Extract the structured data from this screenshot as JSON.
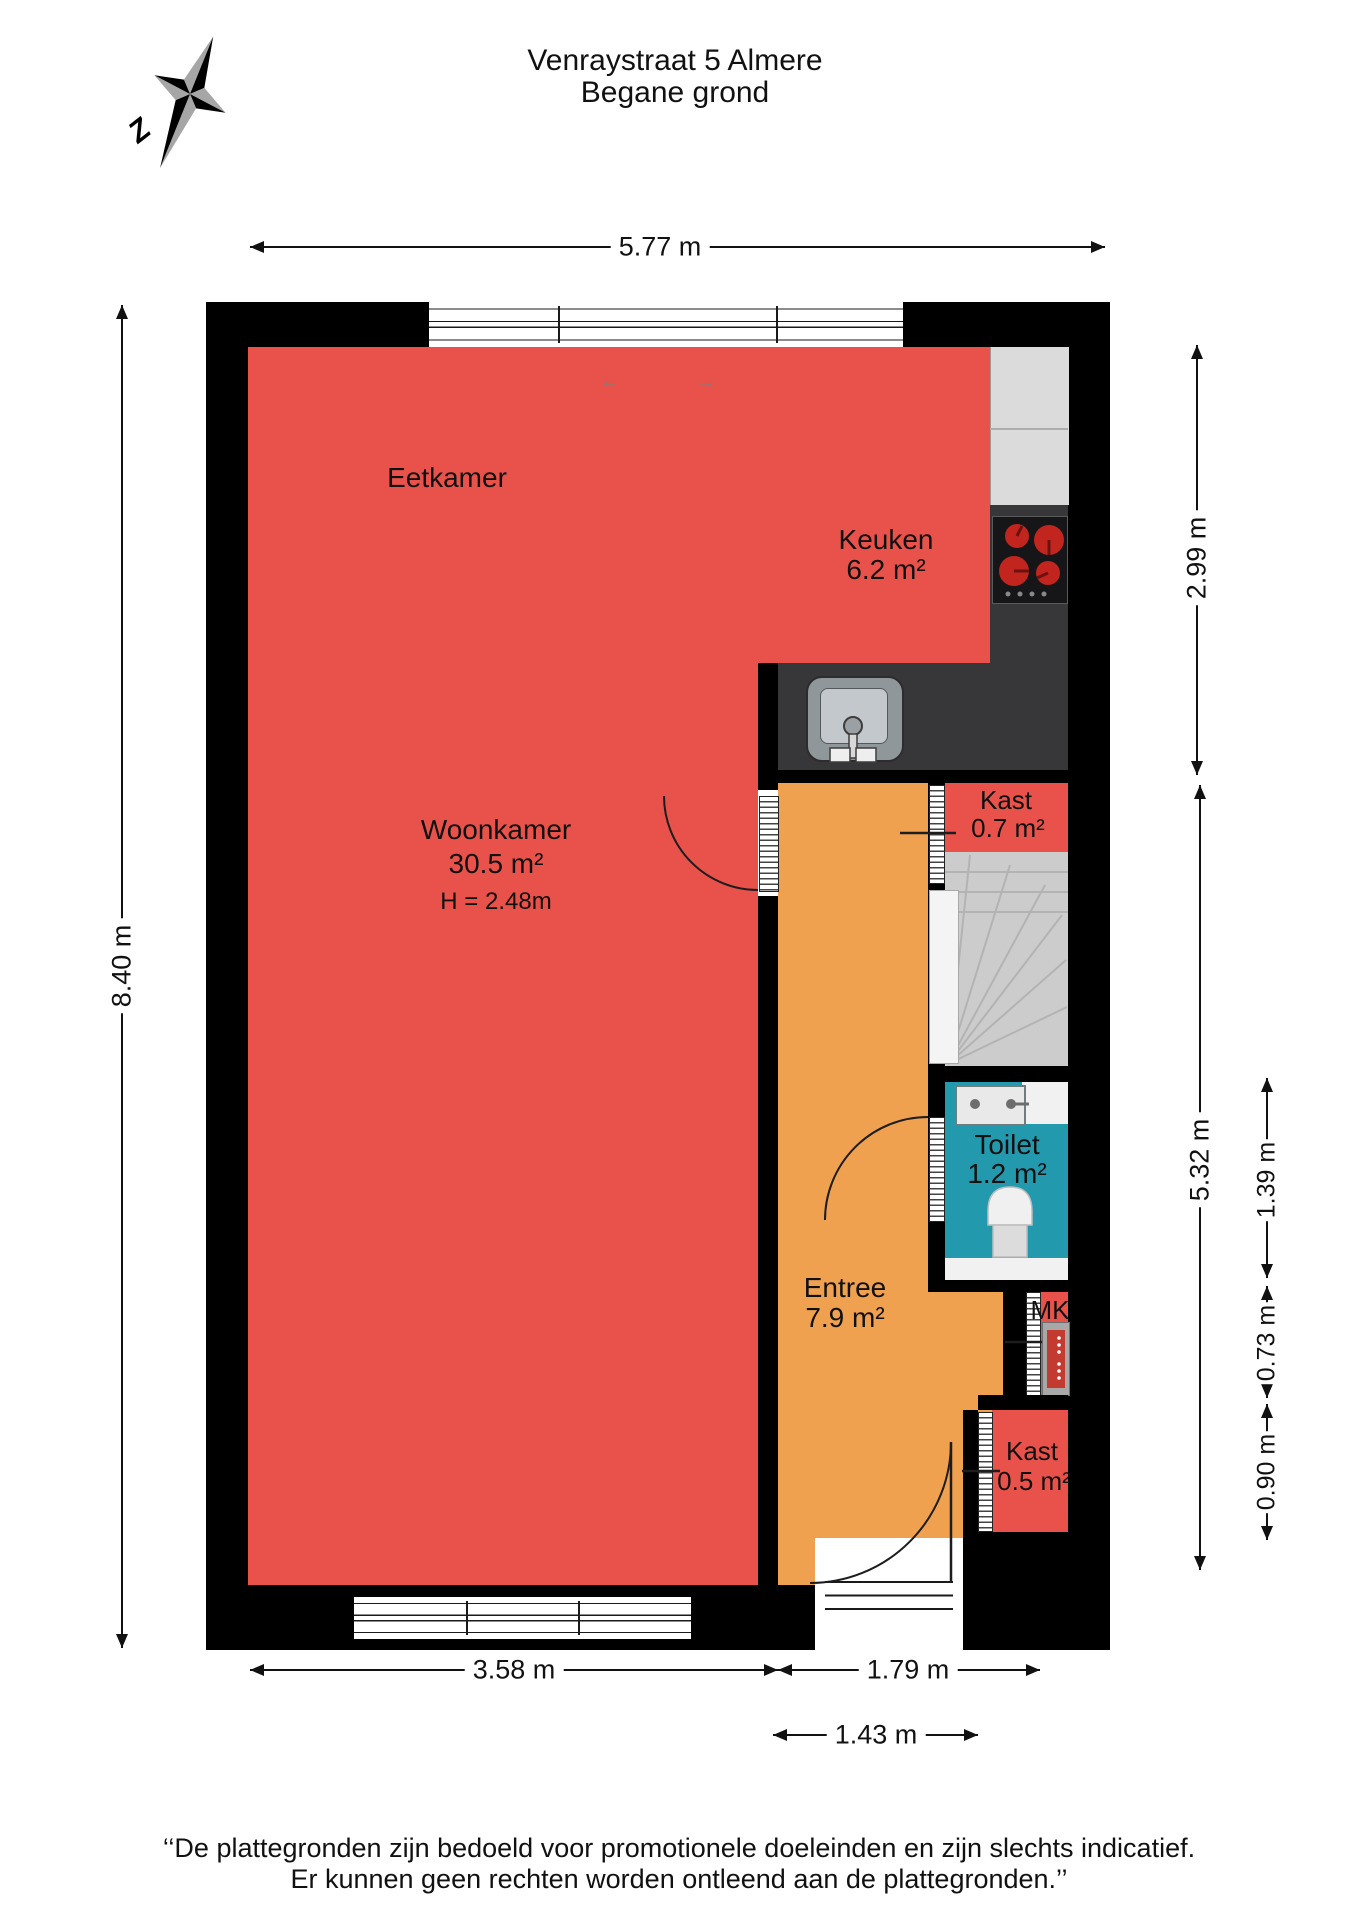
{
  "header": {
    "title_line1": "Venraystraat 5 Almere",
    "title_line2": "Begane grond",
    "compass_label": "Z"
  },
  "rooms": {
    "eetkamer": {
      "name": "Eetkamer"
    },
    "keuken": {
      "name": "Keuken",
      "area": "6.2 m²"
    },
    "woonkamer": {
      "name": "Woonkamer",
      "area": "30.5 m²",
      "height": "H = 2.48m"
    },
    "kast_boven": {
      "name": "Kast",
      "area": "0.7 m²"
    },
    "toilet": {
      "name": "Toilet",
      "area": "1.2 m²"
    },
    "entree": {
      "name": "Entree",
      "area": "7.9 m²"
    },
    "mk": {
      "name": "MK"
    },
    "kast_onder": {
      "name": "Kast",
      "area": "0.5 m²"
    }
  },
  "dimensions": {
    "top": "5.77 m",
    "left": "8.40 m",
    "right_upper": "2.99 m",
    "right_lower": "5.32 m",
    "far_right_upper": "1.39 m",
    "far_right_middle": "0.73 m",
    "far_right_lower": "0.90 m",
    "bottom_left": "3.58 m",
    "bottom_right": "1.79 m",
    "bottom_inner": "1.43 m"
  },
  "window_arrows": {
    "left": "←",
    "right": "→"
  },
  "disclaimer": {
    "line1": "‘‘De plattegronden zijn bedoeld voor promotionele doeleinden en zijn slechts indicatief.",
    "line2": "Er kunnen geen rechten worden ontleend aan de plattegronden.’’"
  },
  "colors": {
    "room_red": "#e8524a",
    "hall_orange": "#f0a14f",
    "toilet_teal": "#2399ae",
    "wall_black": "#000000",
    "counter_light": "#dbdbdb",
    "counter_dark": "#37373a",
    "stairs_gray": "#cccccc",
    "burner_red": "#c2251d"
  }
}
